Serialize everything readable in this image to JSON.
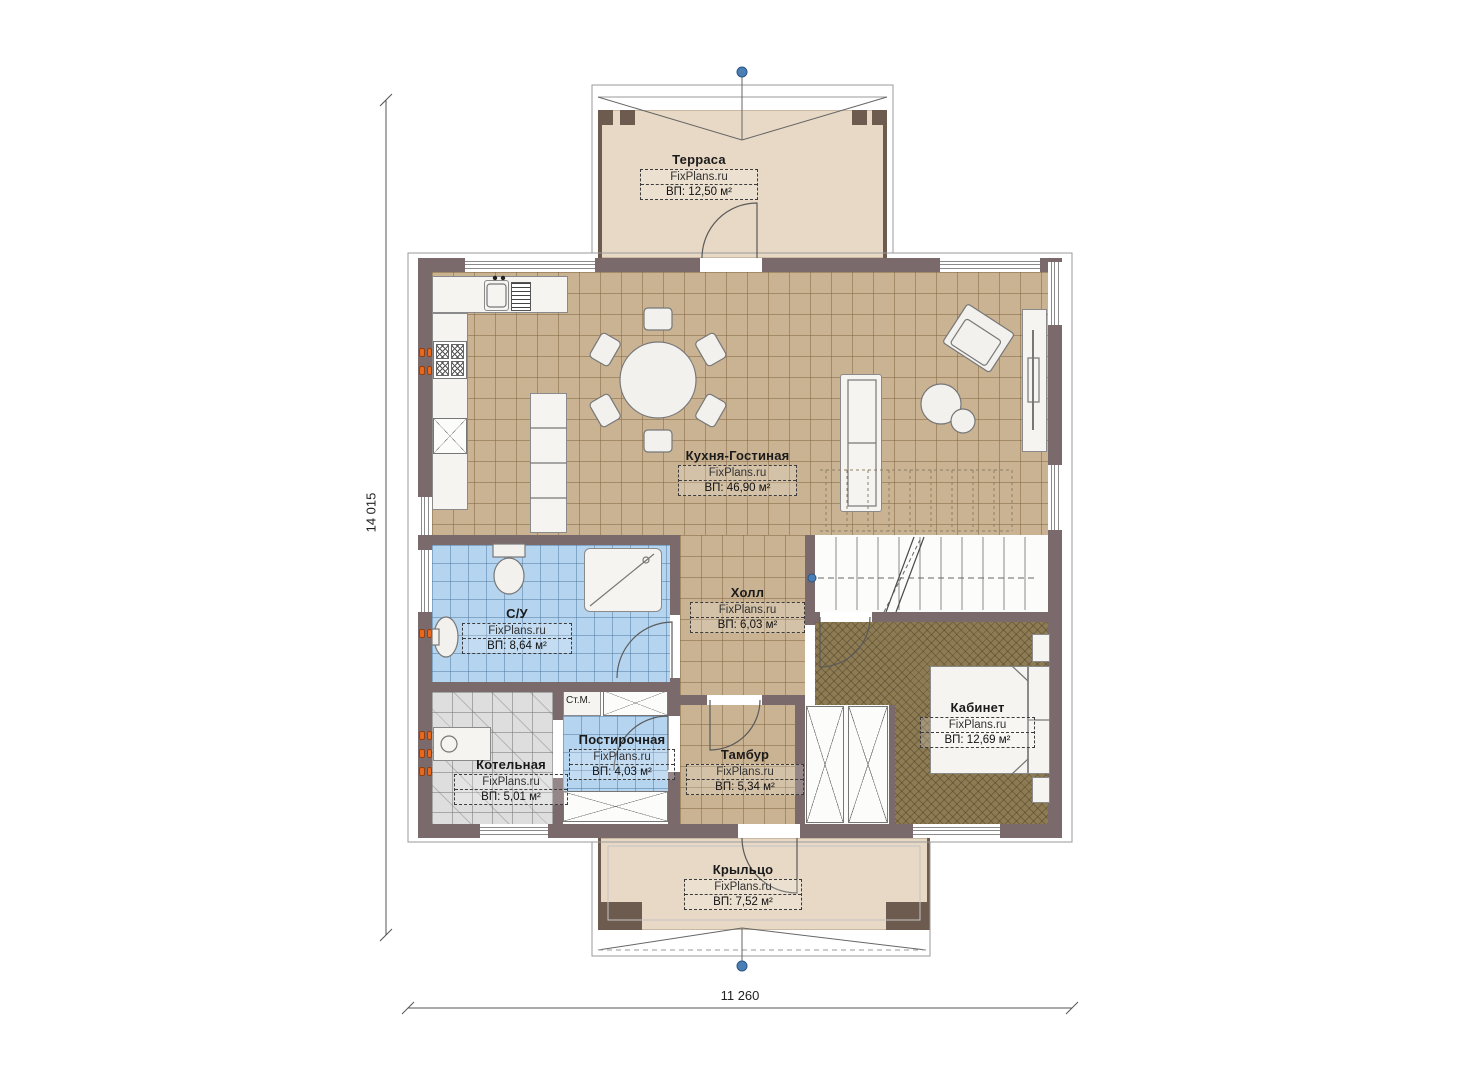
{
  "plan": {
    "brand": "FixPlans.ru",
    "dimension_left": "14 015",
    "dimension_bottom": "11 260",
    "washing_machine_label": "Ст.М.",
    "rooms": [
      {
        "name": "Терраса",
        "area": "ВП: 12,50 м²"
      },
      {
        "name": "Кухня-Гостиная",
        "area": "ВП: 46,90 м²"
      },
      {
        "name": "Холл",
        "area": "ВП: 6,03 м²"
      },
      {
        "name": "С/У",
        "area": "ВП: 8,64 м²"
      },
      {
        "name": "Постирочная",
        "area": "ВП: 4,03 м²"
      },
      {
        "name": "Котельная",
        "area": "ВП: 5,01 м²"
      },
      {
        "name": "Тамбур",
        "area": "ВП: 5,34 м²"
      },
      {
        "name": "Кабинет",
        "area": "ВП: 12,69 м²"
      },
      {
        "name": "Крыльцо",
        "area": "ВП: 7,52 м²"
      }
    ],
    "colors": {
      "wall": "#7b6a6b",
      "tile_floor": "#cab393",
      "wet_floor": "#b4d4ef",
      "office_floor": "#8d7b54",
      "deck": "#e8d9c6",
      "radiator_orange": "#e8681f",
      "axis_marker_blue": "#4a7fb5"
    }
  }
}
